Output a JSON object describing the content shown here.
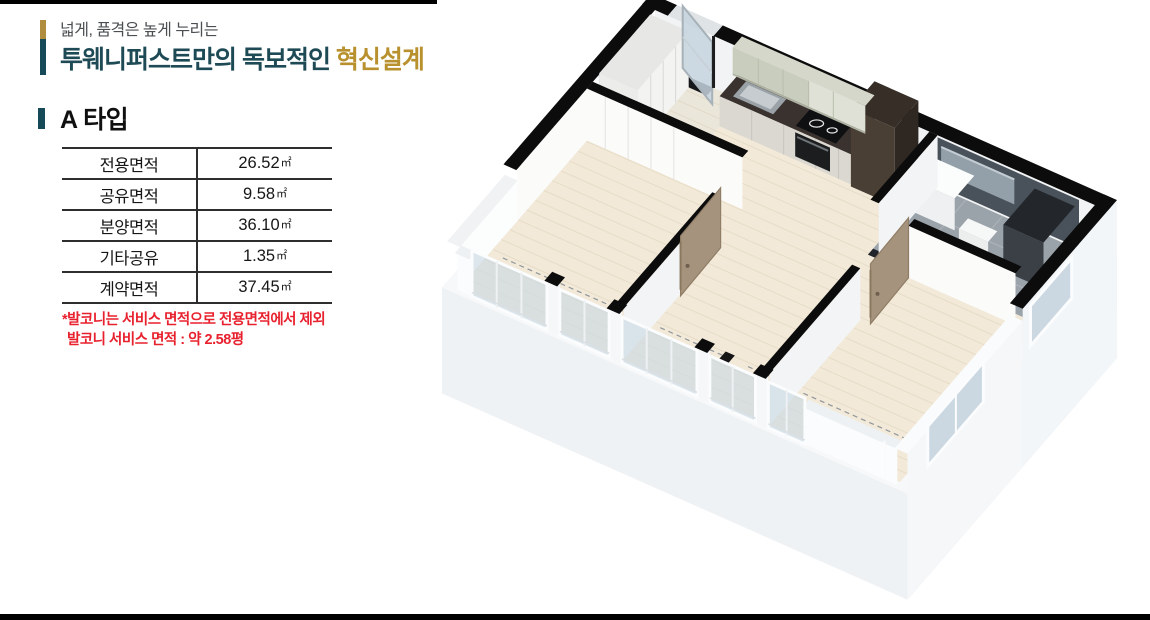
{
  "page": {
    "decor": {
      "top_bar_color": "#000000",
      "bottom_bar_color": "#000000"
    },
    "header": {
      "subtitle": "넓게, 품격은 높게 누리는",
      "title_main": "투웨니퍼스트만의 독보적인 ",
      "title_accent": "혁신설계",
      "title_color": "#1d4a55",
      "accent_color": "#b8912e",
      "bar_gold": "#b08d3e",
      "bar_teal": "#174a58"
    },
    "section": {
      "label": "A 타입",
      "bar_color": "#174a58"
    },
    "area_table": {
      "rows": [
        {
          "label": "전용면적",
          "value": "26.52",
          "unit": "㎡"
        },
        {
          "label": "공유면적",
          "value": "9.58",
          "unit": "㎡"
        },
        {
          "label": "분양면적",
          "value": "36.10",
          "unit": "㎡"
        },
        {
          "label": "기타공유",
          "value": "1.35",
          "unit": "㎡"
        },
        {
          "label": "계약면적",
          "value": "37.45",
          "unit": "㎡"
        }
      ]
    },
    "note": {
      "line1": "*발코니는 서비스 면적으로 전용면적에서 제외",
      "line2": "발코니 서비스 면적 : 약 2.58평",
      "color": "#e8212e"
    }
  },
  "floor_plan": {
    "description": "A타입 3D 아이소메트릭 평면도",
    "colors": {
      "black": "#0c0c0c",
      "wood": "#f2e9d8",
      "wood_grain": "#d9cdb4",
      "entry_floor": "#eae6da",
      "slab_top": "#f6f8f9",
      "slab_left": "#eff2f4",
      "slab_right": "#e4e9ed",
      "wall_bright": "#fbfbfa",
      "wall_light": "#f3f4f5",
      "wall_exterior": "#f3f6f8",
      "glass": "rgba(203,218,227,0.65)",
      "glass_solid": "rgba(198,212,222,0.9)",
      "frame_white": "#fbfcfd",
      "door_tan": "#a6937d",
      "door_tan_dark": "#8f7d66",
      "cabinet_sage": "#c9cdbd",
      "cabinet_cream": "#dfe1d6",
      "cabinet_front": "#dbd8d1",
      "counter_dark": "#3a322f",
      "backsplash": "#4a413c",
      "fridge_top": "#362e27",
      "fridge_front": "#4a3f35",
      "tile_wall": "#49525a",
      "tile_floor": "#9ba3aa",
      "mirror": "#93a0a9",
      "shower_top": "#23272b",
      "shower_front": "#3a4046",
      "fixture_white": "#fbfcfc",
      "dash": "#8f969b"
    }
  }
}
